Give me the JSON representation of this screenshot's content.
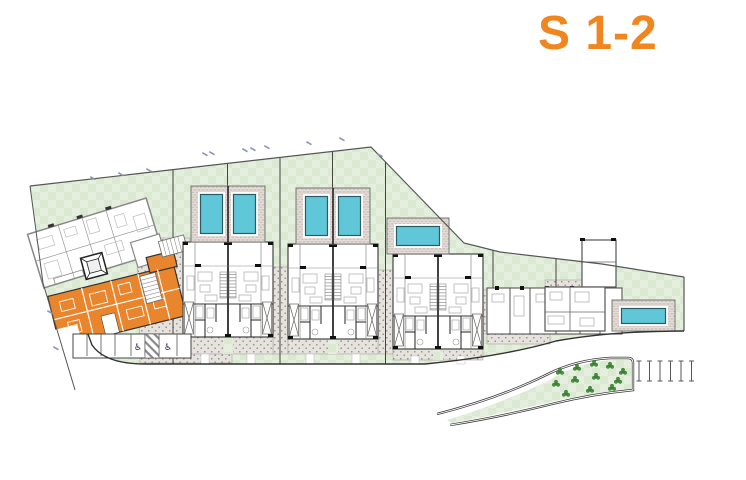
{
  "title": {
    "text": "S 1-2",
    "color": "#F0861F"
  },
  "plan": {
    "highlighted_unit_color": "#E9852C",
    "pool_color": "#5FC7D8",
    "grass_color": "#E5EFDE",
    "paving_color": "#E6E3DE",
    "pool_count": 6,
    "duplex_block_count": 3,
    "rotated_building_count": 2
  },
  "parking": {
    "stall_count": 8,
    "disabled_icon": "♿",
    "disabled_stall_count": 2
  },
  "landscape": {
    "tree_count": 12
  }
}
